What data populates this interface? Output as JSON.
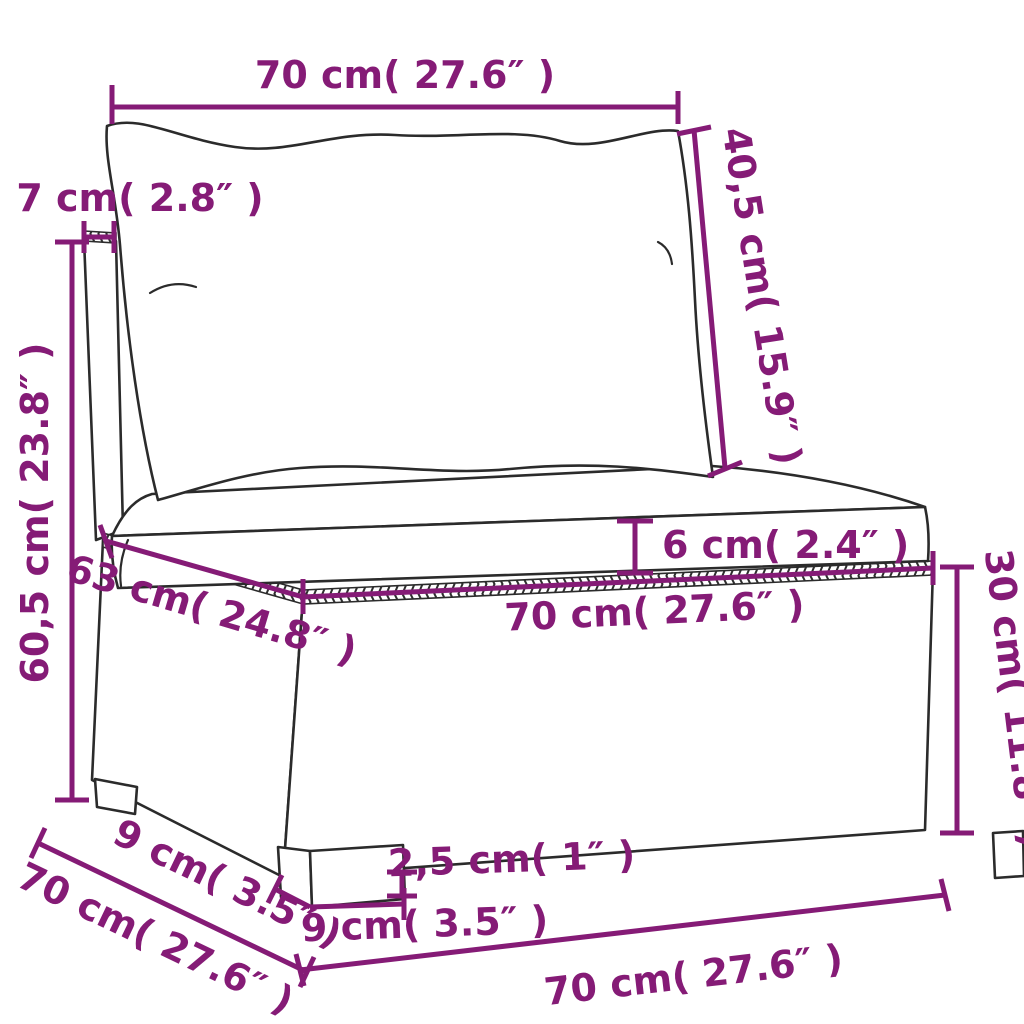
{
  "diagram": {
    "subject": "wicker-middle-sofa-with-cushions-dimension-diagram",
    "colors": {
      "dimension": "#851b76",
      "outline": "#2b2b2b",
      "cushion_top": "#efe9da",
      "background": "#ffffff"
    },
    "dimensions": {
      "back_cushion_width": {
        "label": "70 cm( 27.6″ )",
        "cm": "70",
        "inch": "27.6"
      },
      "back_cushion_height": {
        "label": "40,5 cm( 15.9″ )",
        "cm": "40,5",
        "inch": "15.9"
      },
      "back_panel_thickness": {
        "label": "7 cm( 2.8″ )",
        "cm": "7",
        "inch": "2.8"
      },
      "total_height": {
        "label": "60,5 cm( 23.8″ )",
        "cm": "60,5",
        "inch": "23.8"
      },
      "seat_cushion_thickness": {
        "label": "6 cm( 2.4″ )",
        "cm": "6",
        "inch": "2.4"
      },
      "base_top_depth": {
        "label": "63 cm( 24.8″ )",
        "cm": "63",
        "inch": "24.8"
      },
      "base_top_width": {
        "label": "70 cm( 27.6″ )",
        "cm": "70",
        "inch": "27.6"
      },
      "base_height": {
        "label": "30 cm( 11.8″ )",
        "cm": "30",
        "inch": "11.8"
      },
      "seat_depth": {
        "label": "70 cm( 27.6″ )",
        "cm": "70",
        "inch": "27.6"
      },
      "leg_depth": {
        "label": "9 cm( 3.5″ )",
        "cm": "9",
        "inch": "3.5"
      },
      "leg_height": {
        "label": "2,5 cm( 1″ )",
        "cm": "2,5",
        "inch": "1"
      },
      "leg_width": {
        "label": "9 cm( 3.5″ )",
        "cm": "9",
        "inch": "3.5"
      },
      "front_bottom_width": {
        "label": "70 cm( 27.6″ )",
        "cm": "70",
        "inch": "27.6"
      }
    }
  }
}
